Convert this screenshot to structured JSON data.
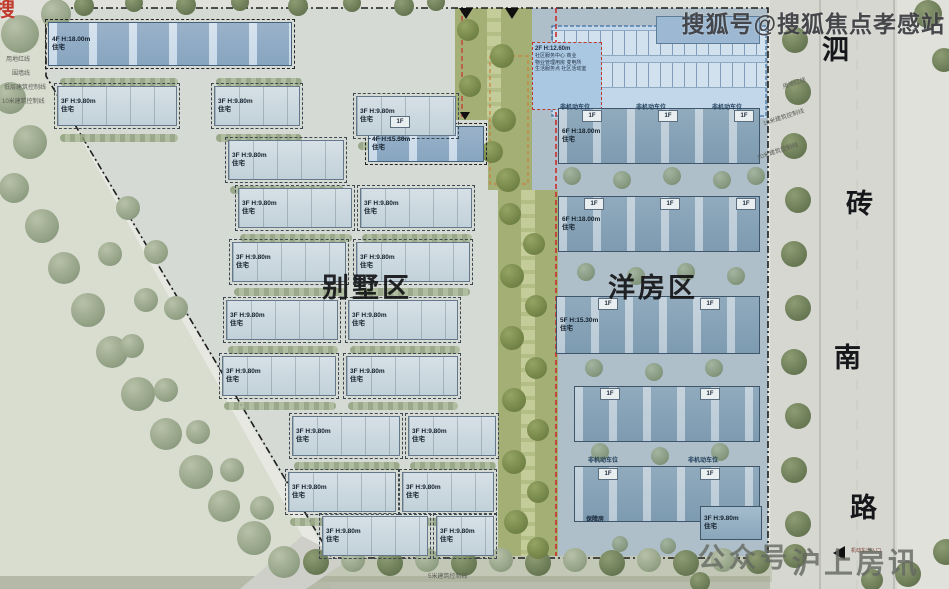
{
  "watermarks": {
    "top": "搜狐号@搜狐焦点孝感站",
    "corner_partial": "搜",
    "bottom_prefix": "公众号",
    "bottom_name": "沪上房讯"
  },
  "road": {
    "chars": [
      "泗",
      "砖",
      "南",
      "路"
    ]
  },
  "zone_labels": {
    "villa": "别墅区",
    "flats": "洋房区"
  },
  "annotations": {
    "left": [
      "用地红线",
      "围墙线",
      "低层建筑控制线",
      "10米建筑控制线"
    ],
    "right": [
      "用地红线",
      "10米建筑控制线",
      "10米建筑控制线"
    ],
    "bottom": "5米建筑控制线",
    "entrance": "机动车出入口",
    "affordable": "保障房"
  },
  "community_center": {
    "lines": [
      "2F H:12.60m",
      "社区服务中心  商业",
      "物业管理用房  变电所",
      "生活服务点  社区活动室"
    ]
  },
  "parking": {
    "stall_label": "非机动车位",
    "positions": [
      [
        560,
        102
      ],
      [
        636,
        102
      ],
      [
        712,
        102
      ],
      [
        588,
        455
      ],
      [
        688,
        455
      ]
    ]
  },
  "one_f": {
    "label": "1F",
    "positions": [
      [
        390,
        116
      ],
      [
        582,
        110
      ],
      [
        658,
        110
      ],
      [
        734,
        110
      ],
      [
        584,
        198
      ],
      [
        660,
        198
      ],
      [
        736,
        198
      ],
      [
        598,
        298
      ],
      [
        700,
        298
      ],
      [
        600,
        388
      ],
      [
        700,
        388
      ],
      [
        598,
        468
      ],
      [
        700,
        468
      ]
    ]
  },
  "buildings": [
    {
      "t": "bs",
      "x": 48,
      "y": 22,
      "w": 244,
      "h": 44,
      "f": "4F H:18.00m",
      "s": "住宅"
    },
    {
      "t": "bs",
      "x": 368,
      "y": 126,
      "w": 116,
      "h": 36,
      "f": "4F H:15.30m",
      "s": "住宅"
    },
    {
      "t": "bv",
      "x": 57,
      "y": 86,
      "w": 120,
      "h": 40,
      "f": "3F H:9.80m",
      "s": "住宅"
    },
    {
      "t": "bv",
      "x": 214,
      "y": 86,
      "w": 86,
      "h": 40,
      "f": "3F H:9.80m",
      "s": "住宅"
    },
    {
      "t": "bv",
      "x": 356,
      "y": 96,
      "w": 100,
      "h": 40,
      "f": "3F H:9.80m",
      "s": "住宅"
    },
    {
      "t": "bv",
      "x": 228,
      "y": 140,
      "w": 116,
      "h": 40,
      "f": "3F H:9.80m",
      "s": "住宅"
    },
    {
      "t": "bv",
      "x": 238,
      "y": 188,
      "w": 114,
      "h": 40,
      "f": "3F H:9.80m",
      "s": "住宅"
    },
    {
      "t": "bv",
      "x": 360,
      "y": 188,
      "w": 112,
      "h": 40,
      "f": "3F H:9.80m",
      "s": "住宅"
    },
    {
      "t": "bv",
      "x": 232,
      "y": 242,
      "w": 114,
      "h": 40,
      "f": "3F H:9.80m",
      "s": "住宅"
    },
    {
      "t": "bv",
      "x": 356,
      "y": 242,
      "w": 114,
      "h": 40,
      "f": "3F H:9.80m",
      "s": "住宅"
    },
    {
      "t": "bv",
      "x": 226,
      "y": 300,
      "w": 112,
      "h": 40,
      "f": "3F H:9.80m",
      "s": "住宅"
    },
    {
      "t": "bv",
      "x": 348,
      "y": 300,
      "w": 110,
      "h": 40,
      "f": "3F H:9.80m",
      "s": "住宅"
    },
    {
      "t": "bv",
      "x": 222,
      "y": 356,
      "w": 114,
      "h": 40,
      "f": "3F H:9.80m",
      "s": "住宅"
    },
    {
      "t": "bv",
      "x": 346,
      "y": 356,
      "w": 112,
      "h": 40,
      "f": "3F H:9.80m",
      "s": "住宅"
    },
    {
      "t": "bv",
      "x": 292,
      "y": 416,
      "w": 108,
      "h": 40,
      "f": "3F H:9.80m",
      "s": "住宅"
    },
    {
      "t": "bv",
      "x": 408,
      "y": 416,
      "w": 88,
      "h": 40,
      "f": "3F H:9.80m",
      "s": "住宅"
    },
    {
      "t": "bv",
      "x": 288,
      "y": 472,
      "w": 108,
      "h": 40,
      "f": "3F H:9.80m",
      "s": "住宅"
    },
    {
      "t": "bv",
      "x": 402,
      "y": 472,
      "w": 92,
      "h": 40,
      "f": "3F H:9.80m",
      "s": "住宅"
    },
    {
      "t": "bv",
      "x": 322,
      "y": 516,
      "w": 106,
      "h": 40,
      "f": "3F H:9.80m",
      "s": "住宅"
    },
    {
      "t": "bv",
      "x": 436,
      "y": 516,
      "w": 58,
      "h": 40,
      "f": "3F H:9.80m",
      "s": "住宅"
    },
    {
      "t": "bf",
      "x": 558,
      "y": 108,
      "w": 202,
      "h": 56,
      "f": "6F H:18.00m",
      "s": "住宅"
    },
    {
      "t": "bf",
      "x": 558,
      "y": 196,
      "w": 202,
      "h": 56,
      "f": "6F H:18.00m",
      "s": "住宅"
    },
    {
      "t": "bf",
      "x": 556,
      "y": 296,
      "w": 204,
      "h": 58,
      "f": "5F H:15.30m",
      "s": "住宅"
    },
    {
      "t": "bf",
      "x": 574,
      "y": 386,
      "w": 186,
      "h": 56
    },
    {
      "t": "bf",
      "x": 574,
      "y": 466,
      "w": 186,
      "h": 56
    },
    {
      "t": "bf2",
      "x": 700,
      "y": 506,
      "w": 62,
      "h": 34,
      "f": "3F H:9.80m",
      "s": "住宅"
    },
    {
      "t": "bd",
      "x": 656,
      "y": 16,
      "w": 104,
      "h": 28
    }
  ]
}
